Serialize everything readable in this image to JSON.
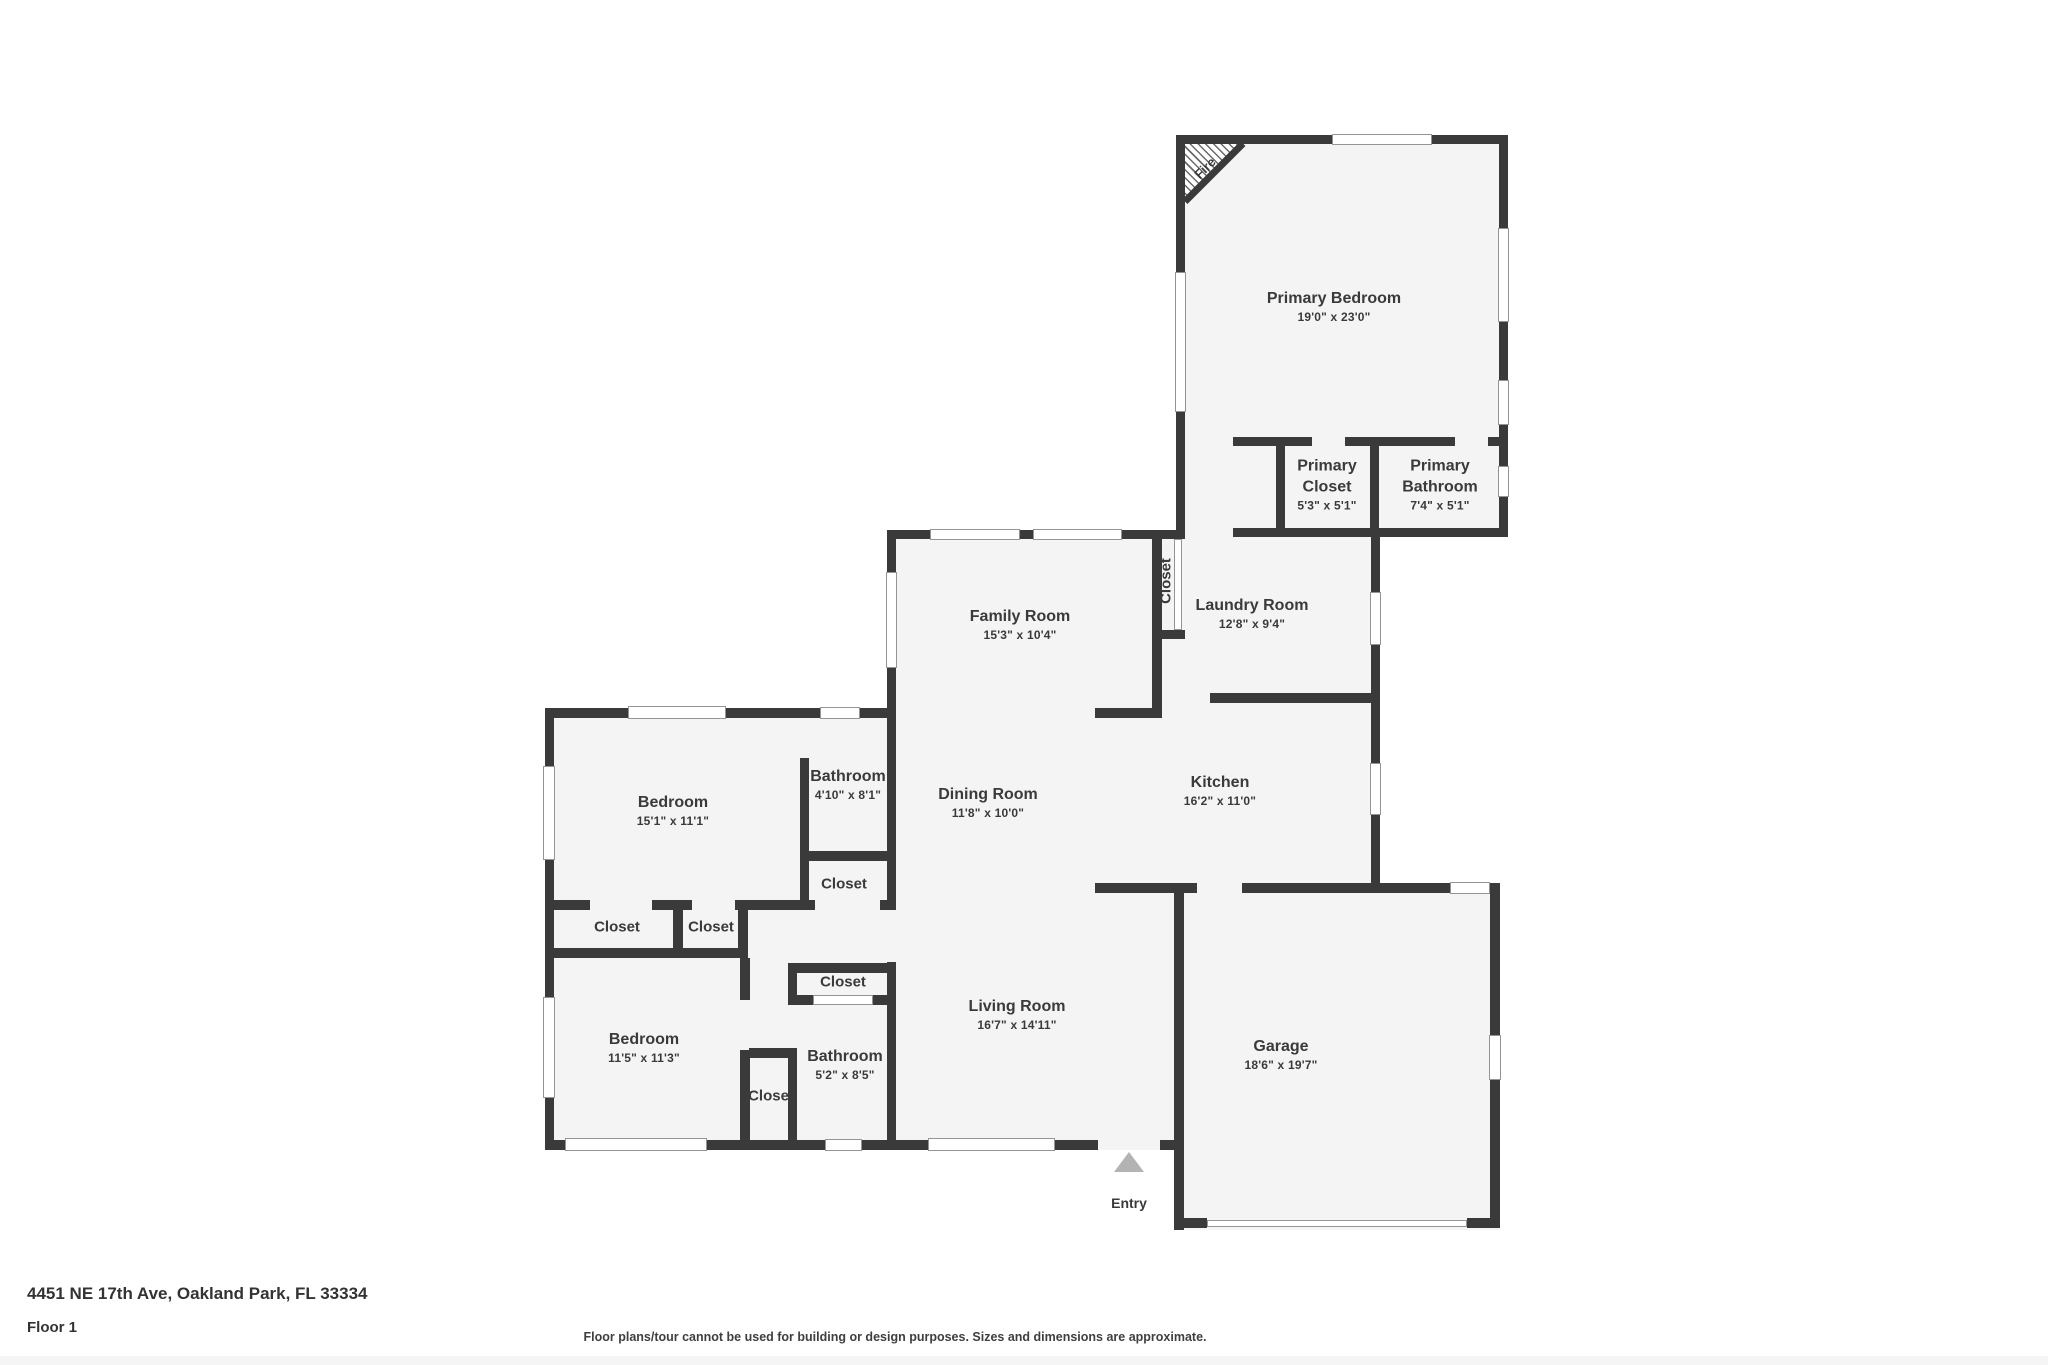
{
  "rooms": [
    {
      "id": "primary-bedroom",
      "name": "Primary Bedroom",
      "dims": "19'0\" x 23'0\""
    },
    {
      "id": "primary-closet",
      "name": "Primary Closet",
      "dims": "5'3\" x 5'1\""
    },
    {
      "id": "primary-bathroom",
      "name": "Primary Bathroom",
      "dims": "7'4\" x 5'1\""
    },
    {
      "id": "family-room",
      "name": "Family Room",
      "dims": "15'3\" x 10'4\""
    },
    {
      "id": "hall-closet",
      "name": "Closet",
      "dims": ""
    },
    {
      "id": "laundry-room",
      "name": "Laundry Room",
      "dims": "12'8\" x 9'4\""
    },
    {
      "id": "dining-room",
      "name": "Dining Room",
      "dims": "11'8\" x 10'0\""
    },
    {
      "id": "kitchen",
      "name": "Kitchen",
      "dims": "16'2\" x 11'0\""
    },
    {
      "id": "bedroom-middle",
      "name": "Bedroom",
      "dims": "15'1\" x 11'1\""
    },
    {
      "id": "bathroom-upper",
      "name": "Bathroom",
      "dims": "4'10\" x 8'1\""
    },
    {
      "id": "closet-under-bathroom",
      "name": "Closet",
      "dims": ""
    },
    {
      "id": "closet-row-left",
      "name": "Closet",
      "dims": ""
    },
    {
      "id": "closet-row-right",
      "name": "Closet",
      "dims": ""
    },
    {
      "id": "bedroom-lower",
      "name": "Bedroom",
      "dims": "11'5\" x 11'3\""
    },
    {
      "id": "closet-mid-bottom",
      "name": "Closet",
      "dims": ""
    },
    {
      "id": "closet-above-bathroom",
      "name": "Closet",
      "dims": ""
    },
    {
      "id": "bathroom-lower",
      "name": "Bathroom",
      "dims": "5'2\" x 8'5\""
    },
    {
      "id": "living-room",
      "name": "Living Room",
      "dims": "16'7\" x 14'11\""
    },
    {
      "id": "garage",
      "name": "Garage",
      "dims": "18'6\" x 19'7\""
    }
  ],
  "annotations": {
    "fire_label": "Fire",
    "entry_label": "Entry"
  },
  "footer": {
    "address": "4451 NE 17th Ave, Oakland Park, FL 33334",
    "floor": "Floor 1",
    "disclaimer": "Floor plans/tour cannot be used for building or design purposes. Sizes and dimensions are approximate."
  },
  "colors": {
    "wall": "#3a3a3a",
    "room_fill": "#f4f4f4",
    "window_frame": "#949494",
    "entry_arrow": "#b3b3b3",
    "text": "#3a3a3a"
  }
}
